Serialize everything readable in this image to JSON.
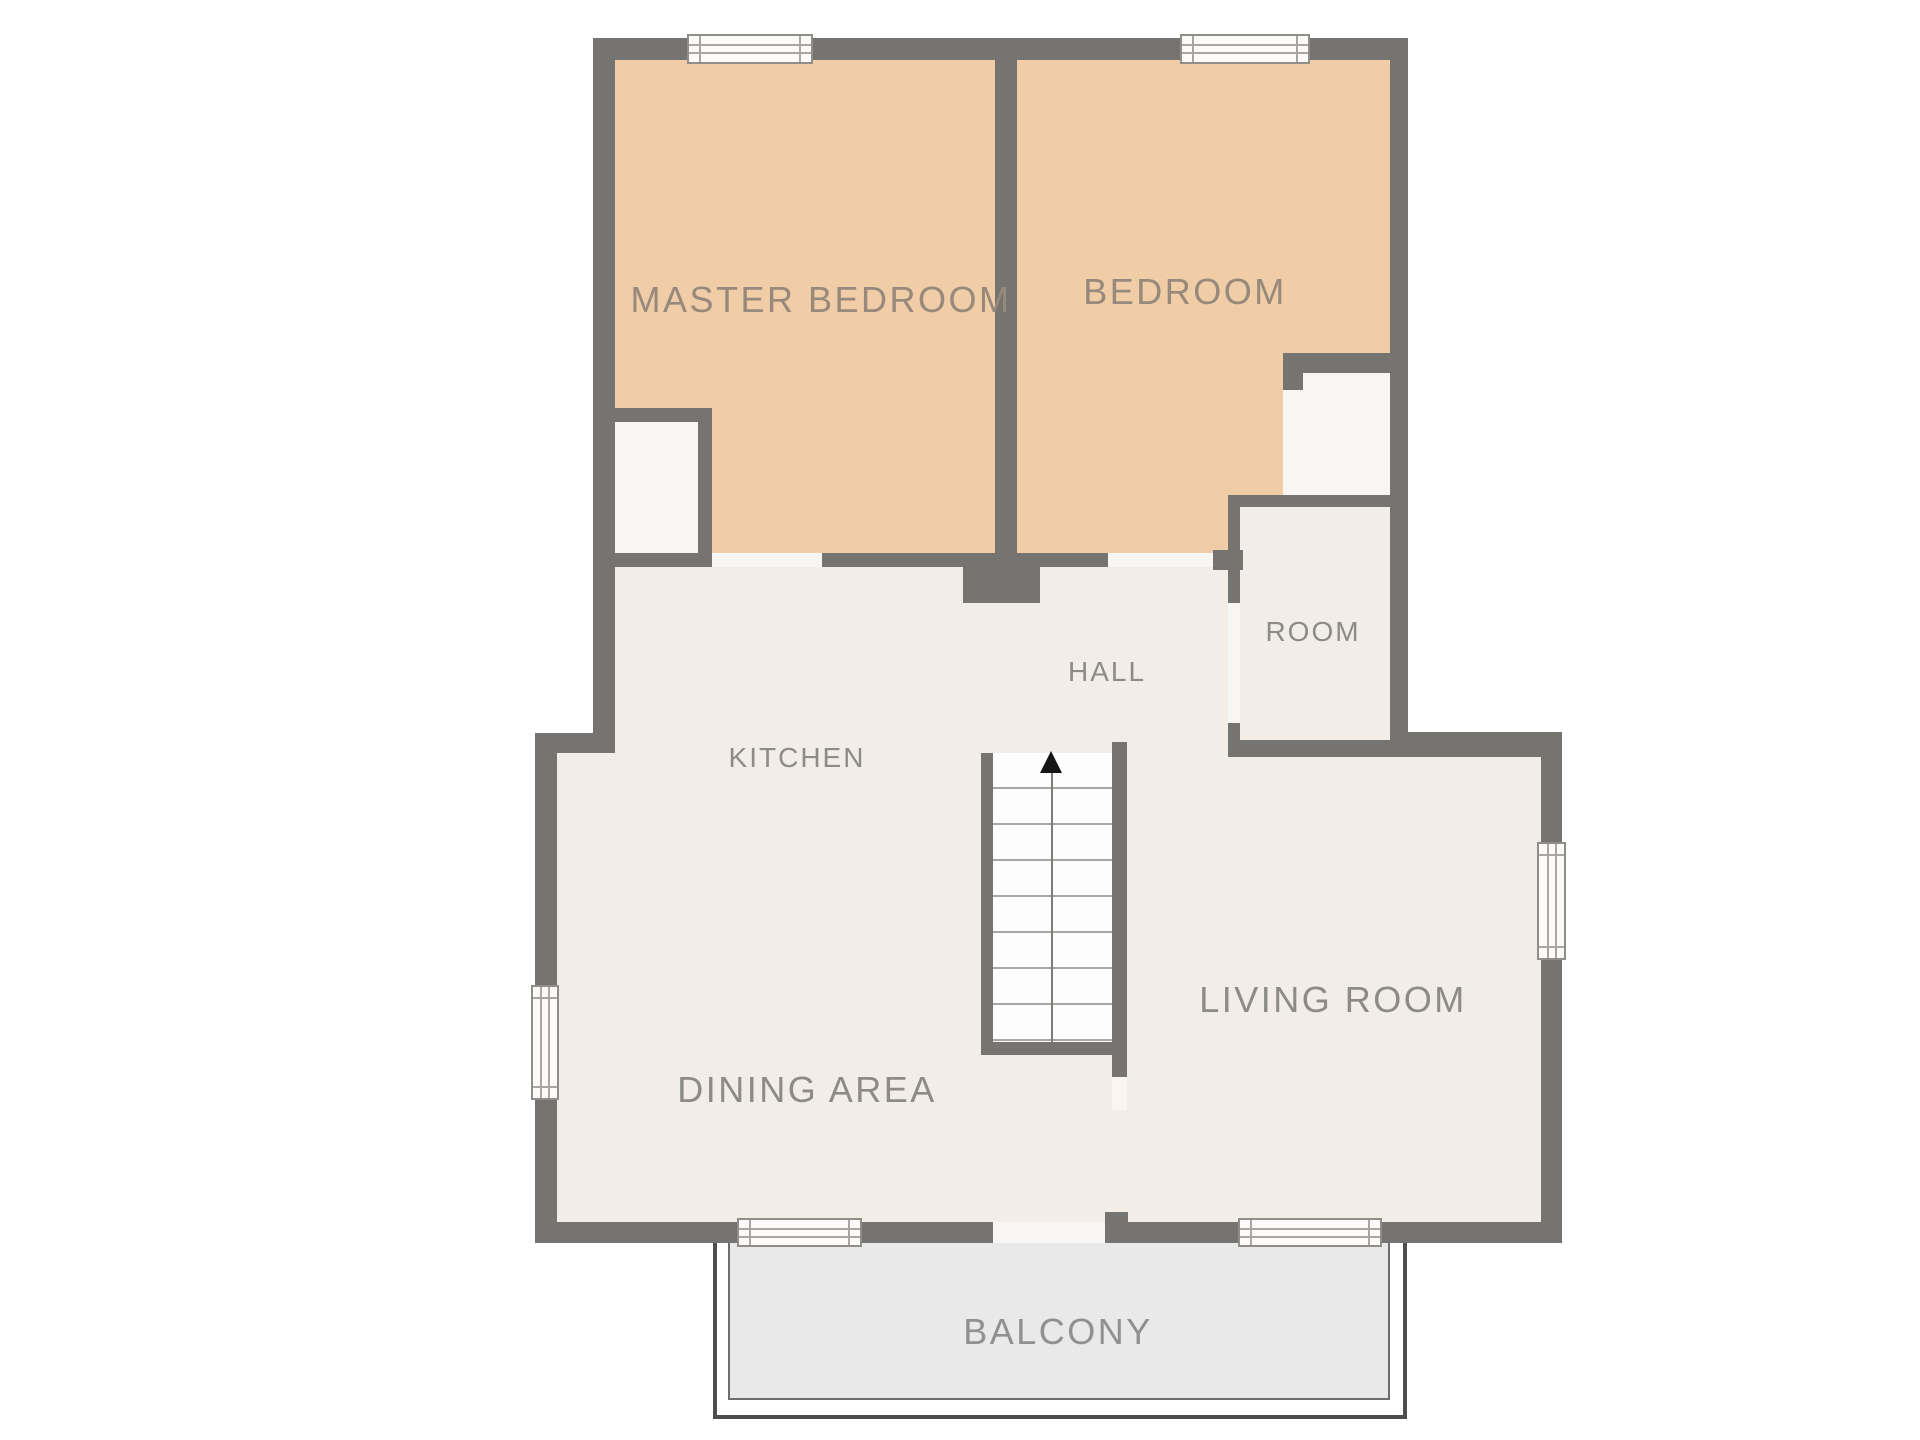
{
  "plan": {
    "type": "apartment-floor-plan",
    "rooms": [
      {
        "id": "master-bedroom",
        "label": "MASTER BEDROOM"
      },
      {
        "id": "bedroom",
        "label": "BEDROOM"
      },
      {
        "id": "room",
        "label": "ROOM"
      },
      {
        "id": "hall",
        "label": "HALL"
      },
      {
        "id": "kitchen",
        "label": "KITCHEN"
      },
      {
        "id": "living-room",
        "label": "LIVING ROOM"
      },
      {
        "id": "dining-area",
        "label": "DINING AREA"
      },
      {
        "id": "balcony",
        "label": "BALCONY"
      }
    ],
    "features": {
      "staircase": {
        "direction_icon": "up-arrow",
        "treads": 8
      },
      "windows": 6,
      "door_openings": [
        "master-bedroom",
        "bedroom",
        "room",
        "balcony",
        "living-room-passage"
      ],
      "closets": 2
    },
    "colors": {
      "wall": "#767470",
      "bedroom_floor": "#f0cca7",
      "interior_floor": "#f2ede7",
      "closet_floor": "#f8f6f2",
      "balcony_floor": "#e9e9e9",
      "stair_floor": "#fdfdfd",
      "label_text": "#8d8b86",
      "bedroom_label_text": "#97897b",
      "background": "#ffffff"
    }
  }
}
